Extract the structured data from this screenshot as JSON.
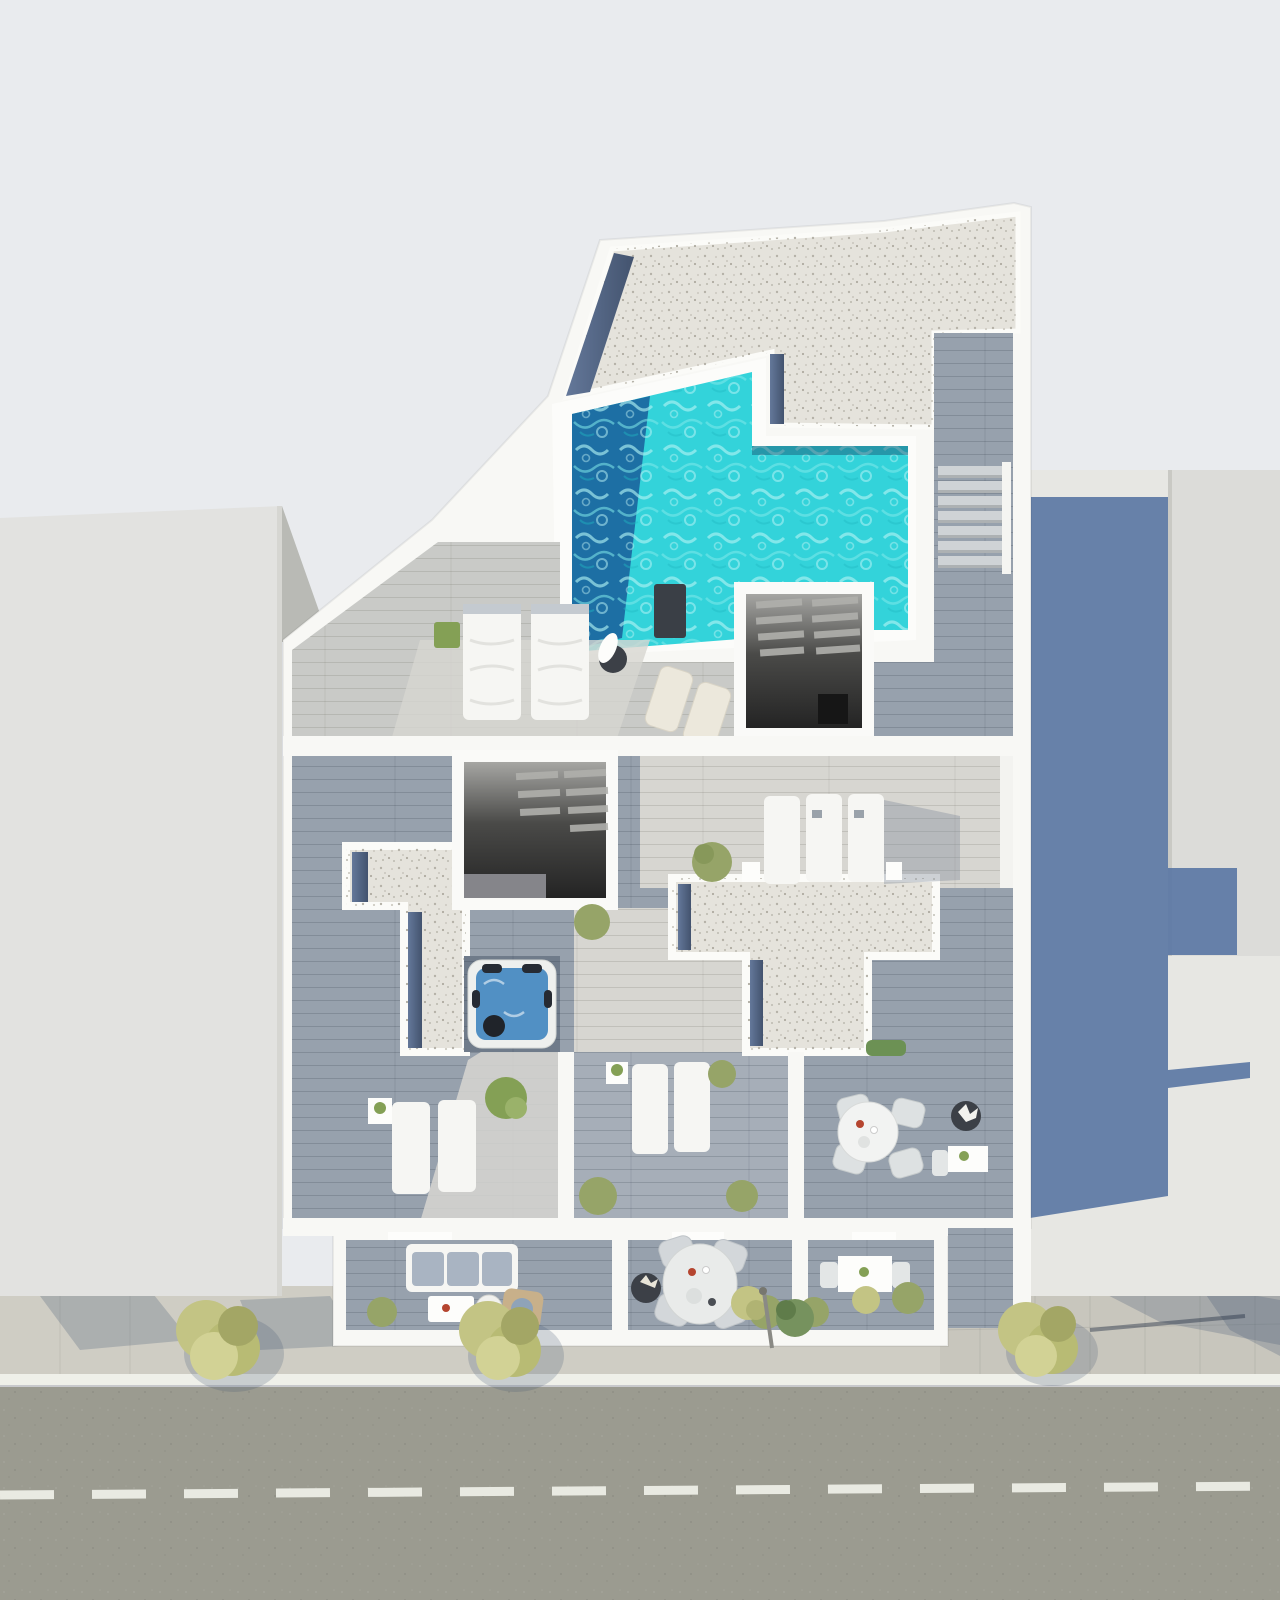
{
  "scene": {
    "title": "Aerial 3D rendering of a residential building rooftop with pool, terraces and street",
    "type": "architectural-render-top-view",
    "labels": {
      "pool": "rooftop swimming pool",
      "gravel_roof": "gravel flat roof",
      "skylight_a": "stairwell skylight opening (upper terrace)",
      "skylight_b": "stairwell skylight opening (middle terrace)",
      "hot_tub": "hot tub",
      "street": "street with dashed center line",
      "left_building": "neighbouring building (left)",
      "right_building": "neighbouring building (right)",
      "cast_shadow": "building shadow cast to the right",
      "balconies": "front balconies with outdoor furniture",
      "trees": "street trees on sidewalk"
    }
  },
  "colors": {
    "bg": "#e9ebee",
    "building_white": "#f8f8f5",
    "left_building": "#e2e2e0",
    "right_building": "#dcdcd9",
    "ground_panel": "#e7e7e3",
    "shade_wall": "#b9bab5",
    "cast_shadow": "#5d78a5",
    "gravel": "#e5e3dc",
    "slate": "#5a6e8e",
    "slate_dark": "#44546f",
    "pool_turquoise": "#33d3da",
    "pool_deep": "#1b66a0",
    "pool_ripple": "#aef1f2",
    "deck_light": "#c9cac7",
    "deck_pale": "#d7d6d1",
    "deck_blue": "#97a1ad",
    "deck_mid": "#a6aeb8",
    "deck_nook": "#6f7b8a",
    "stair_tread": "#cfd3d6",
    "louver": "#b0b0ac",
    "hot_tub_water": "#5190c4",
    "hot_tub_shell": "#eef0ee",
    "furniture_white": "#f6f6f3",
    "cushion_blue": "#a9b4c2",
    "planter_dark": "#3c4047",
    "wicker": "#c8b08a",
    "plant_green": "#84a055",
    "plant_olive": "#96a468",
    "hedge_green": "#6c9154",
    "tree_yellow": "#c3c484",
    "tree_dark": "#76925e",
    "sidewalk": "#cfcdc4",
    "sidewalk_right": "#c8c6bd",
    "curb": "#eff0e9",
    "asphalt": "#9b9b90",
    "road_marking": "#e9eae2",
    "accent_red": "#b5452f",
    "lamp_gray": "#8a8a85"
  }
}
